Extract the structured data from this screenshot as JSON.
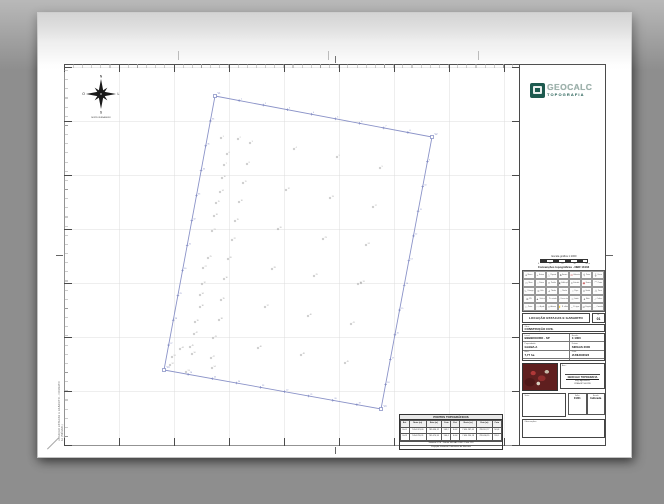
{
  "colors": {
    "accent_green": "#1d5a4f",
    "logo_text": "#9fb3ad",
    "polygon": "#8b93c8",
    "stake": "#7d86c0",
    "point": "#9a9a9a",
    "red_symbol": "#c04040",
    "grid": "#dcdcdc",
    "frame": "#4a4a4a",
    "background": "#8e8e8e"
  },
  "logo": {
    "name": "GEOCALC",
    "subtitle": "TOPOGRAFIA"
  },
  "compass": {
    "n": "N",
    "s": "S",
    "o": "O",
    "l": "L",
    "caption": "NORTE VERDADEIRO"
  },
  "margin_text": "LOCAÇÃO ESTACAS E GABARITO - FORMATO A1 (594x841)",
  "scalebar": {
    "label": "Escala gráfica 1:1000",
    "ticks": [
      "0",
      "10",
      "20",
      "30",
      "40 m"
    ]
  },
  "conventions": {
    "title": "Convenções topográficas - NBR 13133",
    "cells": [
      {
        "sym": "●",
        "label": "Marco",
        "red": false
      },
      {
        "sym": "+",
        "label": "Estaca",
        "red": false
      },
      {
        "sym": "△",
        "label": "Piquete",
        "red": false
      },
      {
        "sym": "♣",
        "label": "Árvore",
        "red": false
      },
      {
        "sym": "⊙",
        "label": "Hidrante",
        "red": true
      },
      {
        "sym": "⚲",
        "label": "Poste",
        "red": false
      },
      {
        "sym": "╫",
        "label": "Cerca",
        "red": false
      },
      {
        "sym": "▭",
        "label": "Muro",
        "red": false
      },
      {
        "sym": "╌",
        "label": "Divisa",
        "red": false
      },
      {
        "sym": "⊓",
        "label": "Portão",
        "red": false
      },
      {
        "sym": "▣",
        "label": "Edificação",
        "red": false
      },
      {
        "sym": "≡",
        "label": "Estrada",
        "red": false
      },
      {
        "sym": "◉",
        "label": "Bueiro",
        "red": true
      },
      {
        "sym": "⌒",
        "label": "Ponte",
        "red": false
      },
      {
        "sym": "∿",
        "label": "Córrego",
        "red": false
      },
      {
        "sym": "≋",
        "label": "Vala",
        "red": false
      },
      {
        "sym": "⊿",
        "label": "Talude",
        "red": false
      },
      {
        "sym": "◌",
        "label": "Rocha",
        "red": false
      },
      {
        "sym": "○",
        "label": "Poço",
        "red": false
      },
      {
        "sym": "#",
        "label": "Grade",
        "red": false
      },
      {
        "sym": "☖",
        "label": "Torre",
        "red": false
      },
      {
        "sym": "⊕",
        "label": "RN",
        "red": false
      },
      {
        "sym": "▲",
        "label": "Vértice",
        "red": false
      },
      {
        "sym": "·",
        "label": "Pt. cotado",
        "red": false
      },
      {
        "sym": "≈",
        "label": "Curva nível",
        "red": false
      },
      {
        "sym": "╍",
        "label": "Limite",
        "red": false
      },
      {
        "sym": "♠",
        "label": "Mata",
        "red": false
      },
      {
        "sym": "∴",
        "label": "Cultura",
        "red": false
      },
      {
        "sym": "∷",
        "label": "Pasto",
        "red": false
      },
      {
        "sym": "◠",
        "label": "Açude",
        "red": false
      },
      {
        "sym": "Y",
        "label": "Antena",
        "red": false
      },
      {
        "sym": "⚡",
        "label": "R. elétrica",
        "red": false
      },
      {
        "sym": "~",
        "label": "R. água",
        "red": false
      },
      {
        "sym": "⊘",
        "label": "Esgoto",
        "red": false
      },
      {
        "sym": "…",
        "label": "Caminho",
        "red": false
      }
    ]
  },
  "titleblock": {
    "title": "LOCAÇÃO ESTACAS E GABARITO",
    "sheet_label": "Fl.",
    "sheet_no": "01",
    "obra_label": "Obra:",
    "obra_value": "CONSTRUÇÃO CIVIL",
    "fields_left": [
      {
        "label": "Local:",
        "value": "BEBEDOURO - SP"
      },
      {
        "label": "Propriedade:",
        "value": "GLEBA A"
      },
      {
        "label": "Área:",
        "value": "7,77 ha"
      }
    ],
    "fields_right": [
      {
        "label": "Escala:",
        "value": "1:1000"
      },
      {
        "label": "Datum:",
        "value": "SIRGAS 2000"
      },
      {
        "label": "Data:",
        "value": "JUNHO/2023"
      }
    ],
    "assinatura_label": "Ass.:",
    "stamp": [
      "GEOCALC TOPOGRAFIA",
      "Eng. Agrimensor",
      "CREA-SP 50612/D"
    ],
    "visto_label": "Visto:",
    "minis": [
      {
        "label": "Folha",
        "value": "01/01"
      },
      {
        "label": "Escala",
        "value": "Indicada"
      }
    ],
    "obs_label": "Observações:"
  },
  "points_table": {
    "title": "PONTOS TOPOGRÁFICOS",
    "headers": [
      "Est.",
      "Norte (m)",
      "Este (m)",
      "Cota",
      "Est.",
      "Norte (m)",
      "Este (m)",
      "Cota"
    ],
    "rows": [
      [
        "E-01",
        "7.654.321,09",
        "789.456,12",
        "563,2",
        "E-02",
        "7.654.287,45",
        "789.512,77",
        "561,8"
      ],
      [
        "E-03",
        "7.654.255,31",
        "789.470,93",
        "560,4",
        "E-04",
        "7.654.230,18",
        "789.430,55",
        "559,1"
      ]
    ],
    "footer": [
      "Sistema UTM - Datum SIRGAS 2000 - Fuso 22S",
      "Projeção Universal Transversa de Mercator"
    ]
  },
  "survey": {
    "polygon": [
      [
        151,
        32
      ],
      [
        368,
        73
      ],
      [
        317,
        345
      ],
      [
        100,
        306
      ]
    ],
    "vertex_labels": [
      "V1",
      "V2",
      "V3",
      "V4"
    ],
    "edge_stakes": [
      8,
      10,
      8,
      10
    ],
    "interior_points": [
      [
        157,
        74
      ],
      [
        174,
        75
      ],
      [
        186,
        79
      ],
      [
        230,
        85
      ],
      [
        273,
        93
      ],
      [
        163,
        90
      ],
      [
        160,
        101
      ],
      [
        183,
        100
      ],
      [
        316,
        104
      ],
      [
        158,
        114
      ],
      [
        179,
        119
      ],
      [
        222,
        126
      ],
      [
        266,
        134
      ],
      [
        156,
        128
      ],
      [
        152,
        139
      ],
      [
        175,
        138
      ],
      [
        309,
        143
      ],
      [
        150,
        152
      ],
      [
        171,
        157
      ],
      [
        214,
        165
      ],
      [
        148,
        167
      ],
      [
        168,
        176
      ],
      [
        259,
        175
      ],
      [
        302,
        181
      ],
      [
        144,
        194
      ],
      [
        164,
        195
      ],
      [
        139,
        204
      ],
      [
        208,
        205
      ],
      [
        250,
        212
      ],
      [
        160,
        215
      ],
      [
        297,
        219
      ],
      [
        138,
        220
      ],
      [
        294,
        220
      ],
      [
        136,
        231
      ],
      [
        157,
        236
      ],
      [
        136,
        243
      ],
      [
        201,
        243
      ],
      [
        155,
        256
      ],
      [
        131,
        258
      ],
      [
        244,
        252
      ],
      [
        287,
        260
      ],
      [
        130,
        270
      ],
      [
        149,
        274
      ],
      [
        116,
        285
      ],
      [
        126,
        283
      ],
      [
        194,
        284
      ],
      [
        147,
        294
      ],
      [
        237,
        291
      ],
      [
        281,
        299
      ],
      [
        128,
        290
      ],
      [
        108,
        293
      ],
      [
        106,
        301
      ],
      [
        122,
        308
      ],
      [
        148,
        304
      ]
    ]
  }
}
